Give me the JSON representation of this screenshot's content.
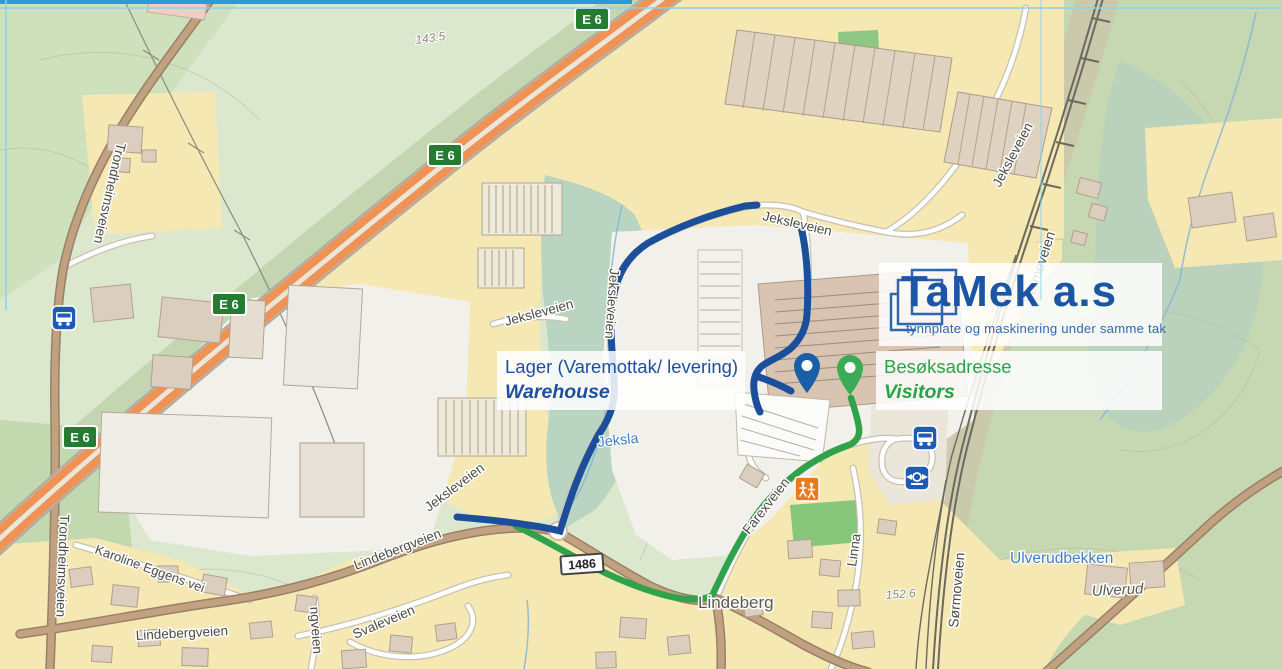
{
  "overlays": {
    "logo": {
      "company": "TaMek a.s",
      "tagline": "tynnplate og maskinering under samme tak"
    },
    "warehouse_label": {
      "norwegian": "Lager (Varemottak/ levering)",
      "english": "Warehouse"
    },
    "visitors_label": {
      "norwegian": "Besøksadresse",
      "english": "Visitors"
    }
  },
  "signs": {
    "e6": "E 6",
    "road_1486": "1486"
  },
  "streets": {
    "trondheimsveien": "Trondheimsveien",
    "jeksleveien": "Jeksleveien",
    "lindebergveien": "Lindebergveien",
    "karoline_eggens_vei": "Karoline Eggens vei",
    "svaleveien": "Svaleveien",
    "ngveien_partial": "ngveien",
    "farexveien": "Farexveien",
    "linna": "Linna",
    "sormoveien": "Sørmoveien"
  },
  "places": {
    "lindeberg": "Lindeberg",
    "ulverud": "Ulverud"
  },
  "water": {
    "jeksla": "Jeksla",
    "ulverudbekken": "Ulverudbekken"
  },
  "elevations": {
    "point_1": "143.5",
    "point_2": "152.6"
  },
  "colors": {
    "warehouse_route": "#1b4f9c",
    "visitors_route": "#2fa24b",
    "warehouse_pin": "#1b5ea8",
    "visitors_pin": "#3cab55",
    "logo_blue": "#1b56a4",
    "label_green": "#2aa246",
    "e6_sign_green": "#267b33",
    "highway_orange": "#ee9355"
  }
}
